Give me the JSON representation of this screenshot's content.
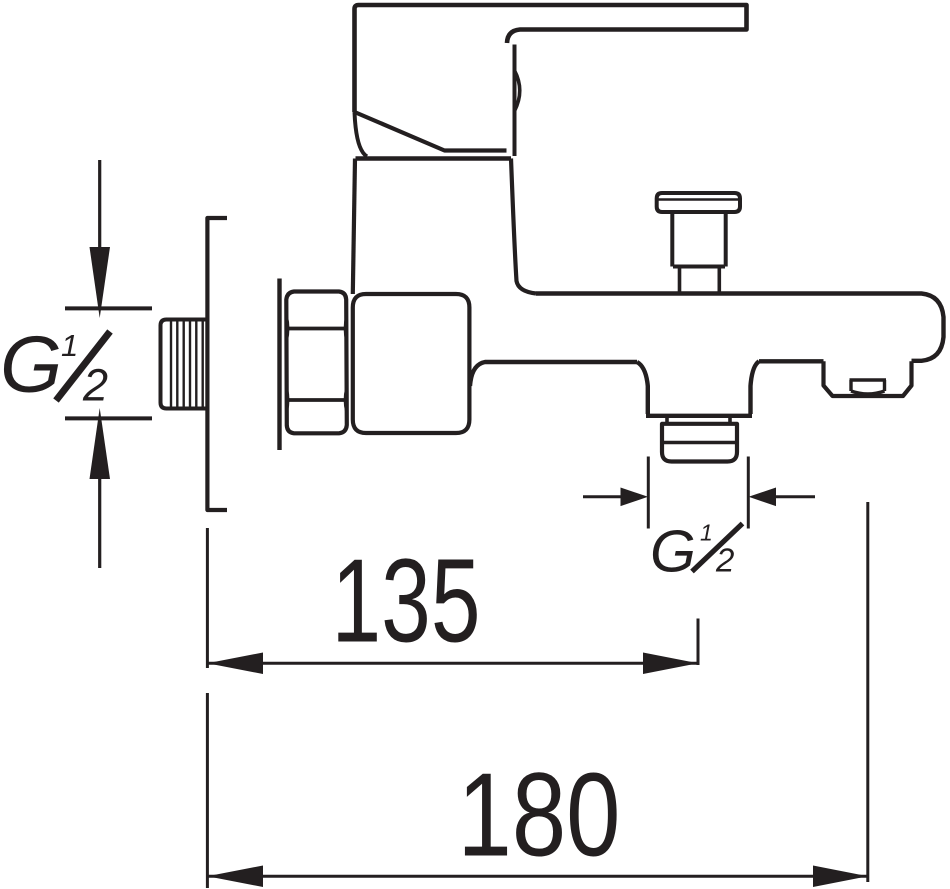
{
  "drawing": {
    "subject": "Wall-mounted single-lever bath shower mixer tap, technical side elevation",
    "ink_color": "#231f20",
    "paper_color": "#ffffff",
    "labels": {
      "wall_thread": {
        "full": "G½",
        "g": "G",
        "num": "1",
        "den": "2"
      },
      "outlet_thread": {
        "full": "G½",
        "g": "G",
        "num": "1",
        "den": "2"
      },
      "dim_spout_to_wall": "135",
      "dim_total_projection": "180"
    }
  }
}
